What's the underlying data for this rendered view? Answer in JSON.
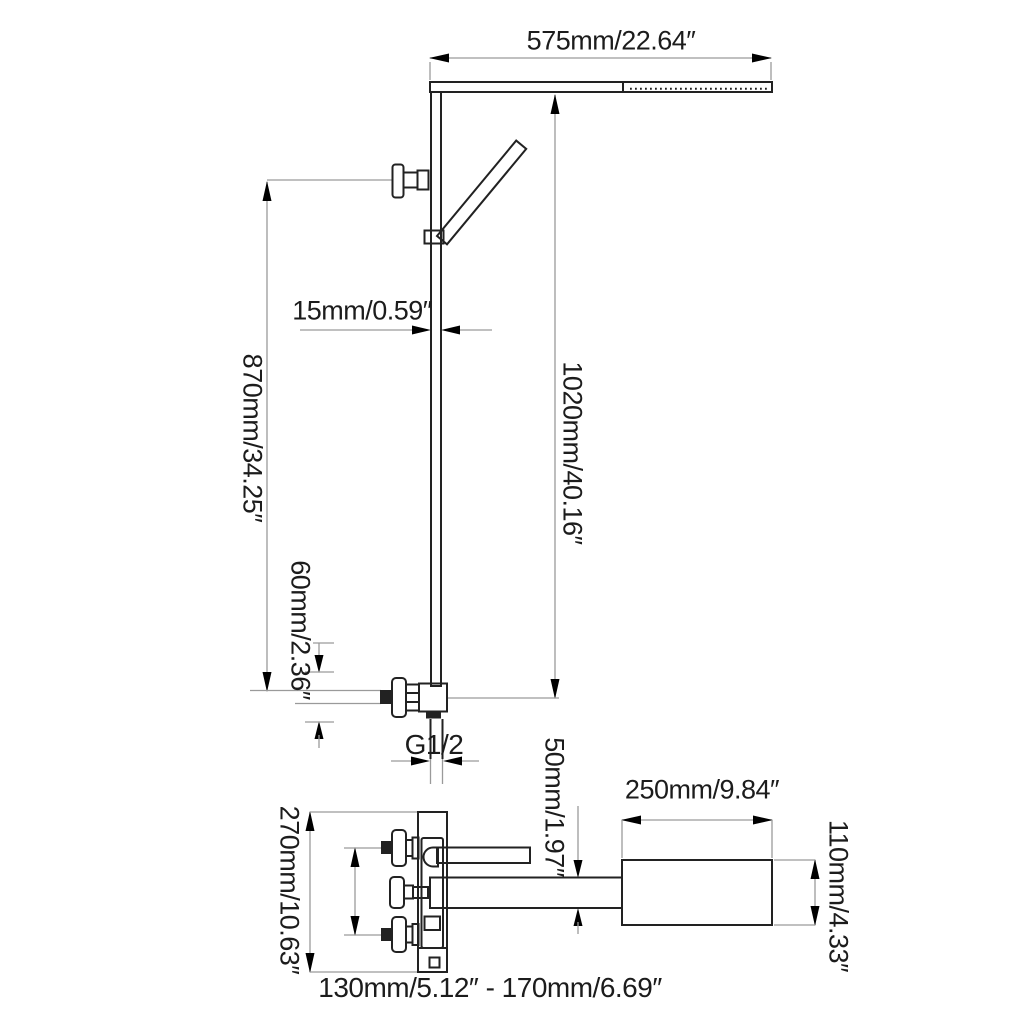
{
  "colors": {
    "background": "#ffffff",
    "outline": "#222222",
    "dimension_line": "#9a9a9a",
    "arrow": "#000000",
    "text": "#1c1c1c"
  },
  "labels": {
    "arm_width": "575mm/22.64″",
    "bar_thickness": "15mm/0.59″",
    "riser_height": "1020mm/40.16″",
    "bracket_height": "870mm/34.25″",
    "valve_offset": "60mm/2.36″",
    "thread_size": "G1/2",
    "plate_height": "270mm/10.63″",
    "spout_height": "50mm/1.97″",
    "head_length": "250mm/9.84″",
    "head_width": "110mm/4.33″",
    "inlet_spacing_range": "130mm/5.12″ - 170mm/6.69″"
  }
}
